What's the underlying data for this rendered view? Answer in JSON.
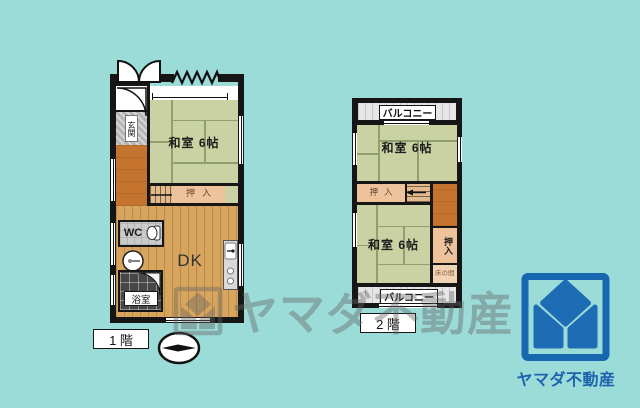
{
  "page": {
    "background": "#9bdcd9"
  },
  "floor1": {
    "label": "1 階",
    "rooms": {
      "washitsu": "和室 6帖",
      "oshiire": "押入",
      "dk": "DK",
      "wc": "WC",
      "bath": "浴室",
      "genkan": "玄関"
    }
  },
  "floor2": {
    "label": "2 階",
    "balcony_top": "バルコニー",
    "balcony_bottom": "バルコニー",
    "rooms": {
      "washitsu_upper": "和室 6帖",
      "washitsu_lower": "和室 6帖",
      "oshiire_mid": "押入",
      "oshiire_right": "押入",
      "tokonoma": "床の間"
    }
  },
  "watermark": {
    "text": "ヤマダ不動産"
  },
  "brand": {
    "name": "ヤマダ不動産",
    "logo_blue": "#1d6cb4"
  },
  "colors": {
    "background": "#9bdcd9",
    "wall": "#161616",
    "tatami": "#cad1a2",
    "wood_floor": "#d8a55e",
    "hallway": "#c4742e",
    "closet": "#eec39b",
    "brand_blue": "#1d6cb4"
  }
}
